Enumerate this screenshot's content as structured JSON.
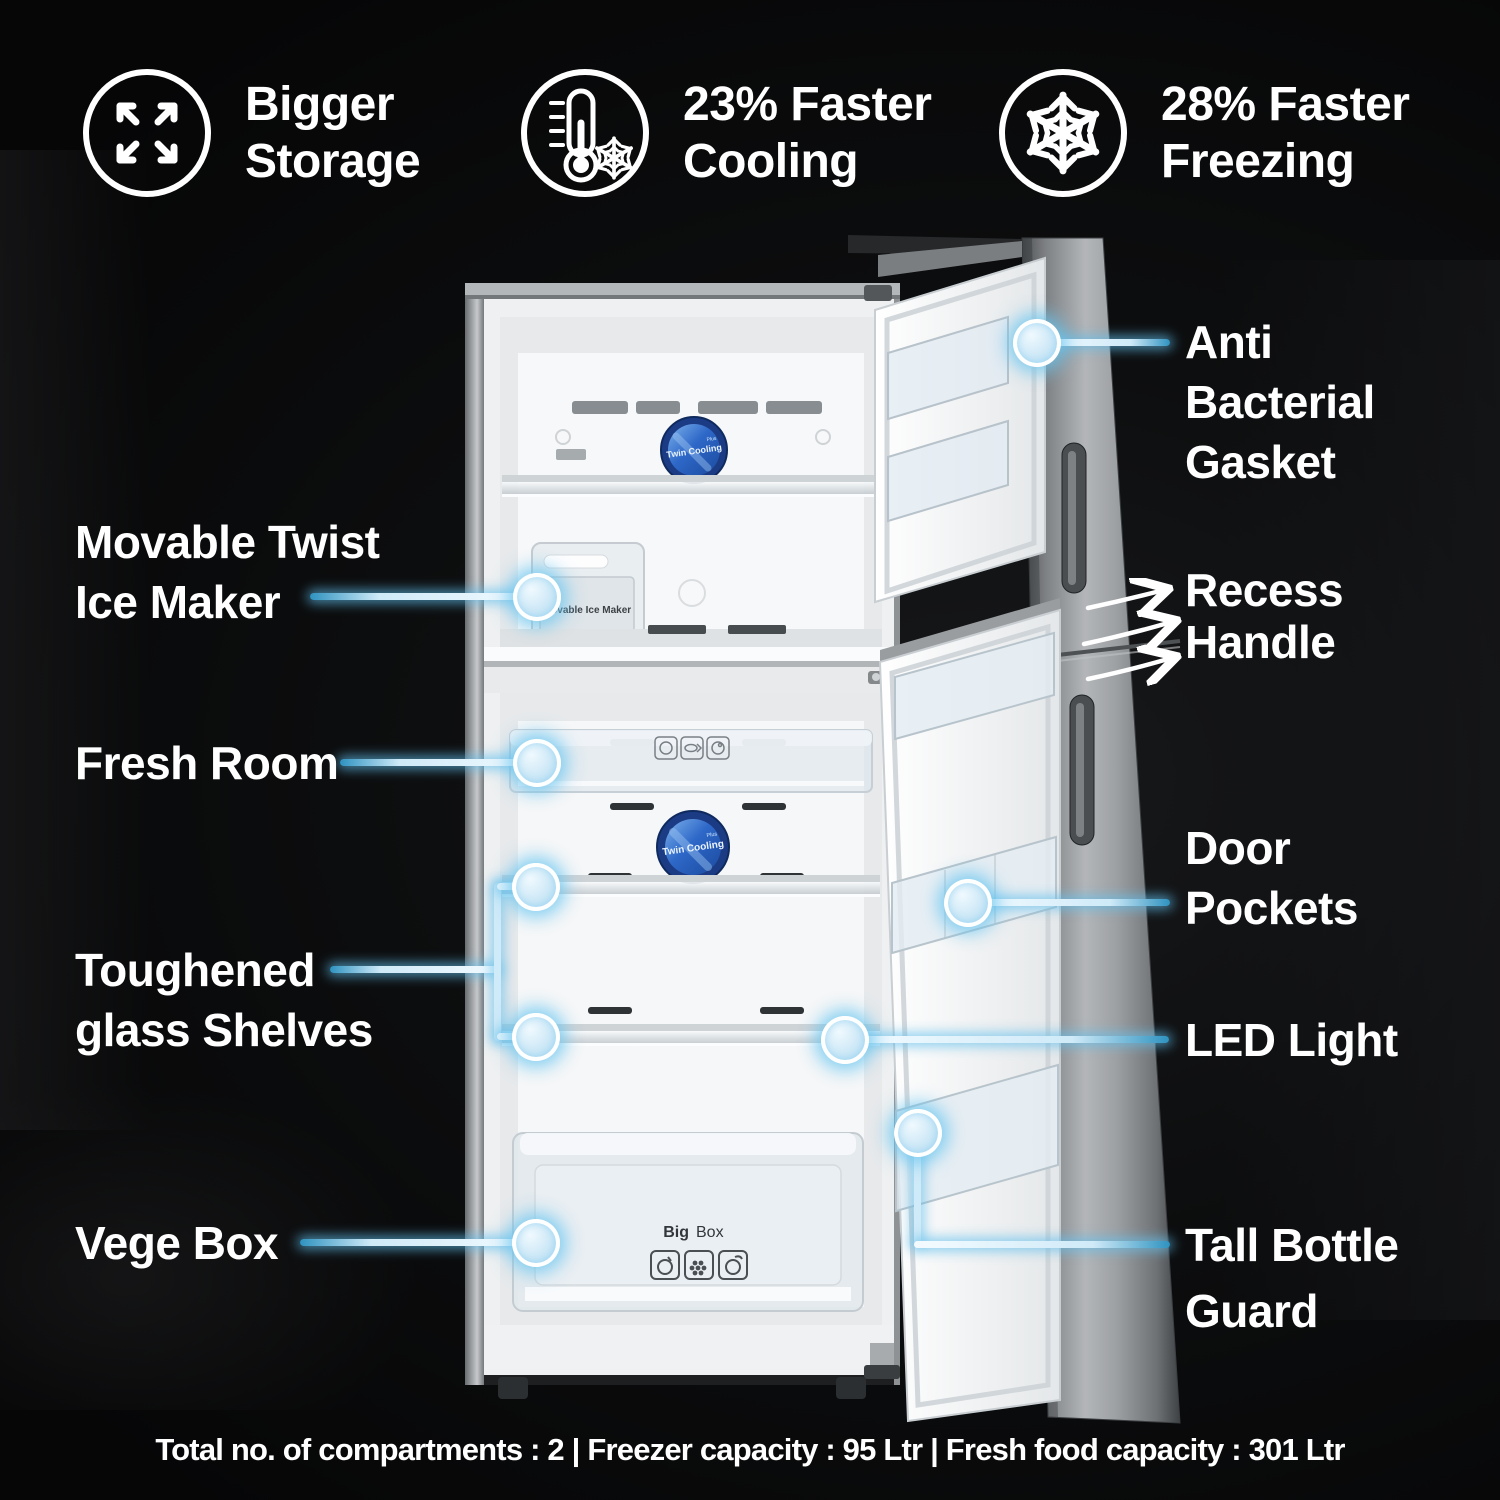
{
  "features": [
    {
      "icon": "expand-arrows-icon",
      "lines": [
        "Bigger",
        "Storage"
      ]
    },
    {
      "icon": "thermometer-snowflake-icon",
      "lines": [
        "23% Faster",
        "Cooling"
      ]
    },
    {
      "icon": "snowflake-icon",
      "lines": [
        "28% Faster",
        "Freezing"
      ]
    }
  ],
  "callouts": {
    "movable_ice_maker": {
      "lines": [
        "Movable Twist",
        "Ice Maker"
      ]
    },
    "fresh_room": {
      "lines": [
        "Fresh Room"
      ]
    },
    "toughened_shelves": {
      "lines": [
        "Toughened",
        "glass Shelves"
      ]
    },
    "vege_box": {
      "lines": [
        "Vege Box"
      ]
    },
    "anti_bacterial_gasket": {
      "lines": [
        "Anti",
        "Bacterial",
        "Gasket"
      ]
    },
    "recess_handle": {
      "lines": [
        "Recess",
        "Handle"
      ]
    },
    "door_pockets": {
      "lines": [
        "Door",
        "Pockets"
      ]
    },
    "led_light": {
      "lines": [
        "LED Light"
      ]
    },
    "tall_bottle_guard": {
      "lines": [
        "Tall Bottle",
        "Guard"
      ]
    }
  },
  "fridge": {
    "badge_title": "Twin Cooling",
    "badge_plus": "Plus",
    "ice_maker_label": "Movable Ice Maker",
    "big_box_bold": "Big",
    "big_box_rest": "Box"
  },
  "footer": "Total no. of compartments : 2 | Freezer capacity : 95 Ltr | Fresh food capacity : 301 Ltr",
  "colors": {
    "glow_blue": "#6ec6ee",
    "line_teal": "#2f93c0",
    "badge_blue": "#2e68c8"
  }
}
